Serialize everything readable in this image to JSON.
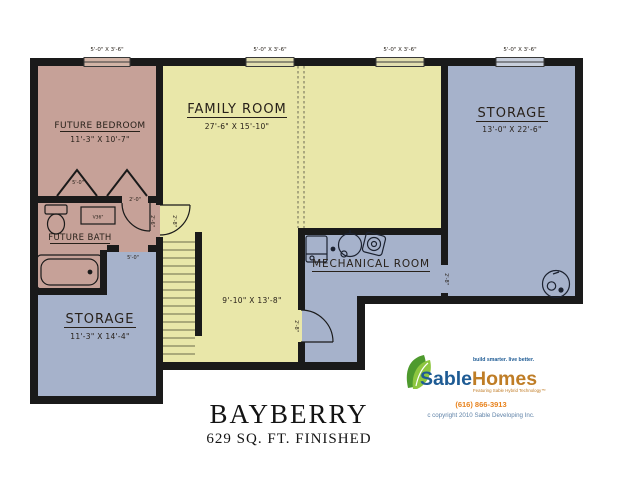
{
  "plan": {
    "title": "BAYBERRY",
    "subtitle": "629 SQ. FT. FINISHED",
    "rooms": {
      "future_bedroom": {
        "name": "FUTURE BEDROOM",
        "dims": "11'-3\" X 10'-7\""
      },
      "family_room": {
        "name": "FAMILY ROOM",
        "dims": "27'-6\" X 15'-10\""
      },
      "storage_upper": {
        "name": "STORAGE",
        "dims": "13'-0\" X 22'-6\""
      },
      "storage_lower": {
        "name": "STORAGE",
        "dims": "11'-3\" X 14'-4\""
      },
      "future_bath": {
        "name": "FUTURE BATH"
      },
      "mechanical_room": {
        "name": "MECHANICAL ROOM"
      },
      "stair_area_dims": "9'-10\" X 13'-8\""
    },
    "windows": [
      "5'-0\" X 3'-6\"",
      "5'-0\" X 3'-6\"",
      "5'-0\" X 3'-6\"",
      "5'-0\" X 3'-6\""
    ],
    "door_labels": {
      "closet": "5'-0\"",
      "bath_door": "2'-0\"",
      "hall_side": "2'-6\"",
      "hall_door": "2'-8\"",
      "storage_opening_left": "5'-0\"",
      "mech_door": "2'-8\"",
      "mech_storage_opening": "2'-8\""
    },
    "vanity_label": "V36\"",
    "colors": {
      "room_pink": "#c6a198",
      "room_yellow": "#e9e7a9",
      "room_blue": "#a6b2cb",
      "wall": "#1a1a1a"
    }
  },
  "logo": {
    "brand_first": "Sable",
    "brand_second": "Homes",
    "tagline": "build smarter. live better.",
    "sub_tagline": "Featuring Sable Hybrid Technology™",
    "phone": "(616) 866-3913",
    "copyright": "c copyright 2010 Sable Developing Inc.",
    "colors": {
      "blue": "#1e5b94",
      "gold": "#bf7d26",
      "green": "#8dc63f",
      "orange": "#e8821c"
    }
  }
}
